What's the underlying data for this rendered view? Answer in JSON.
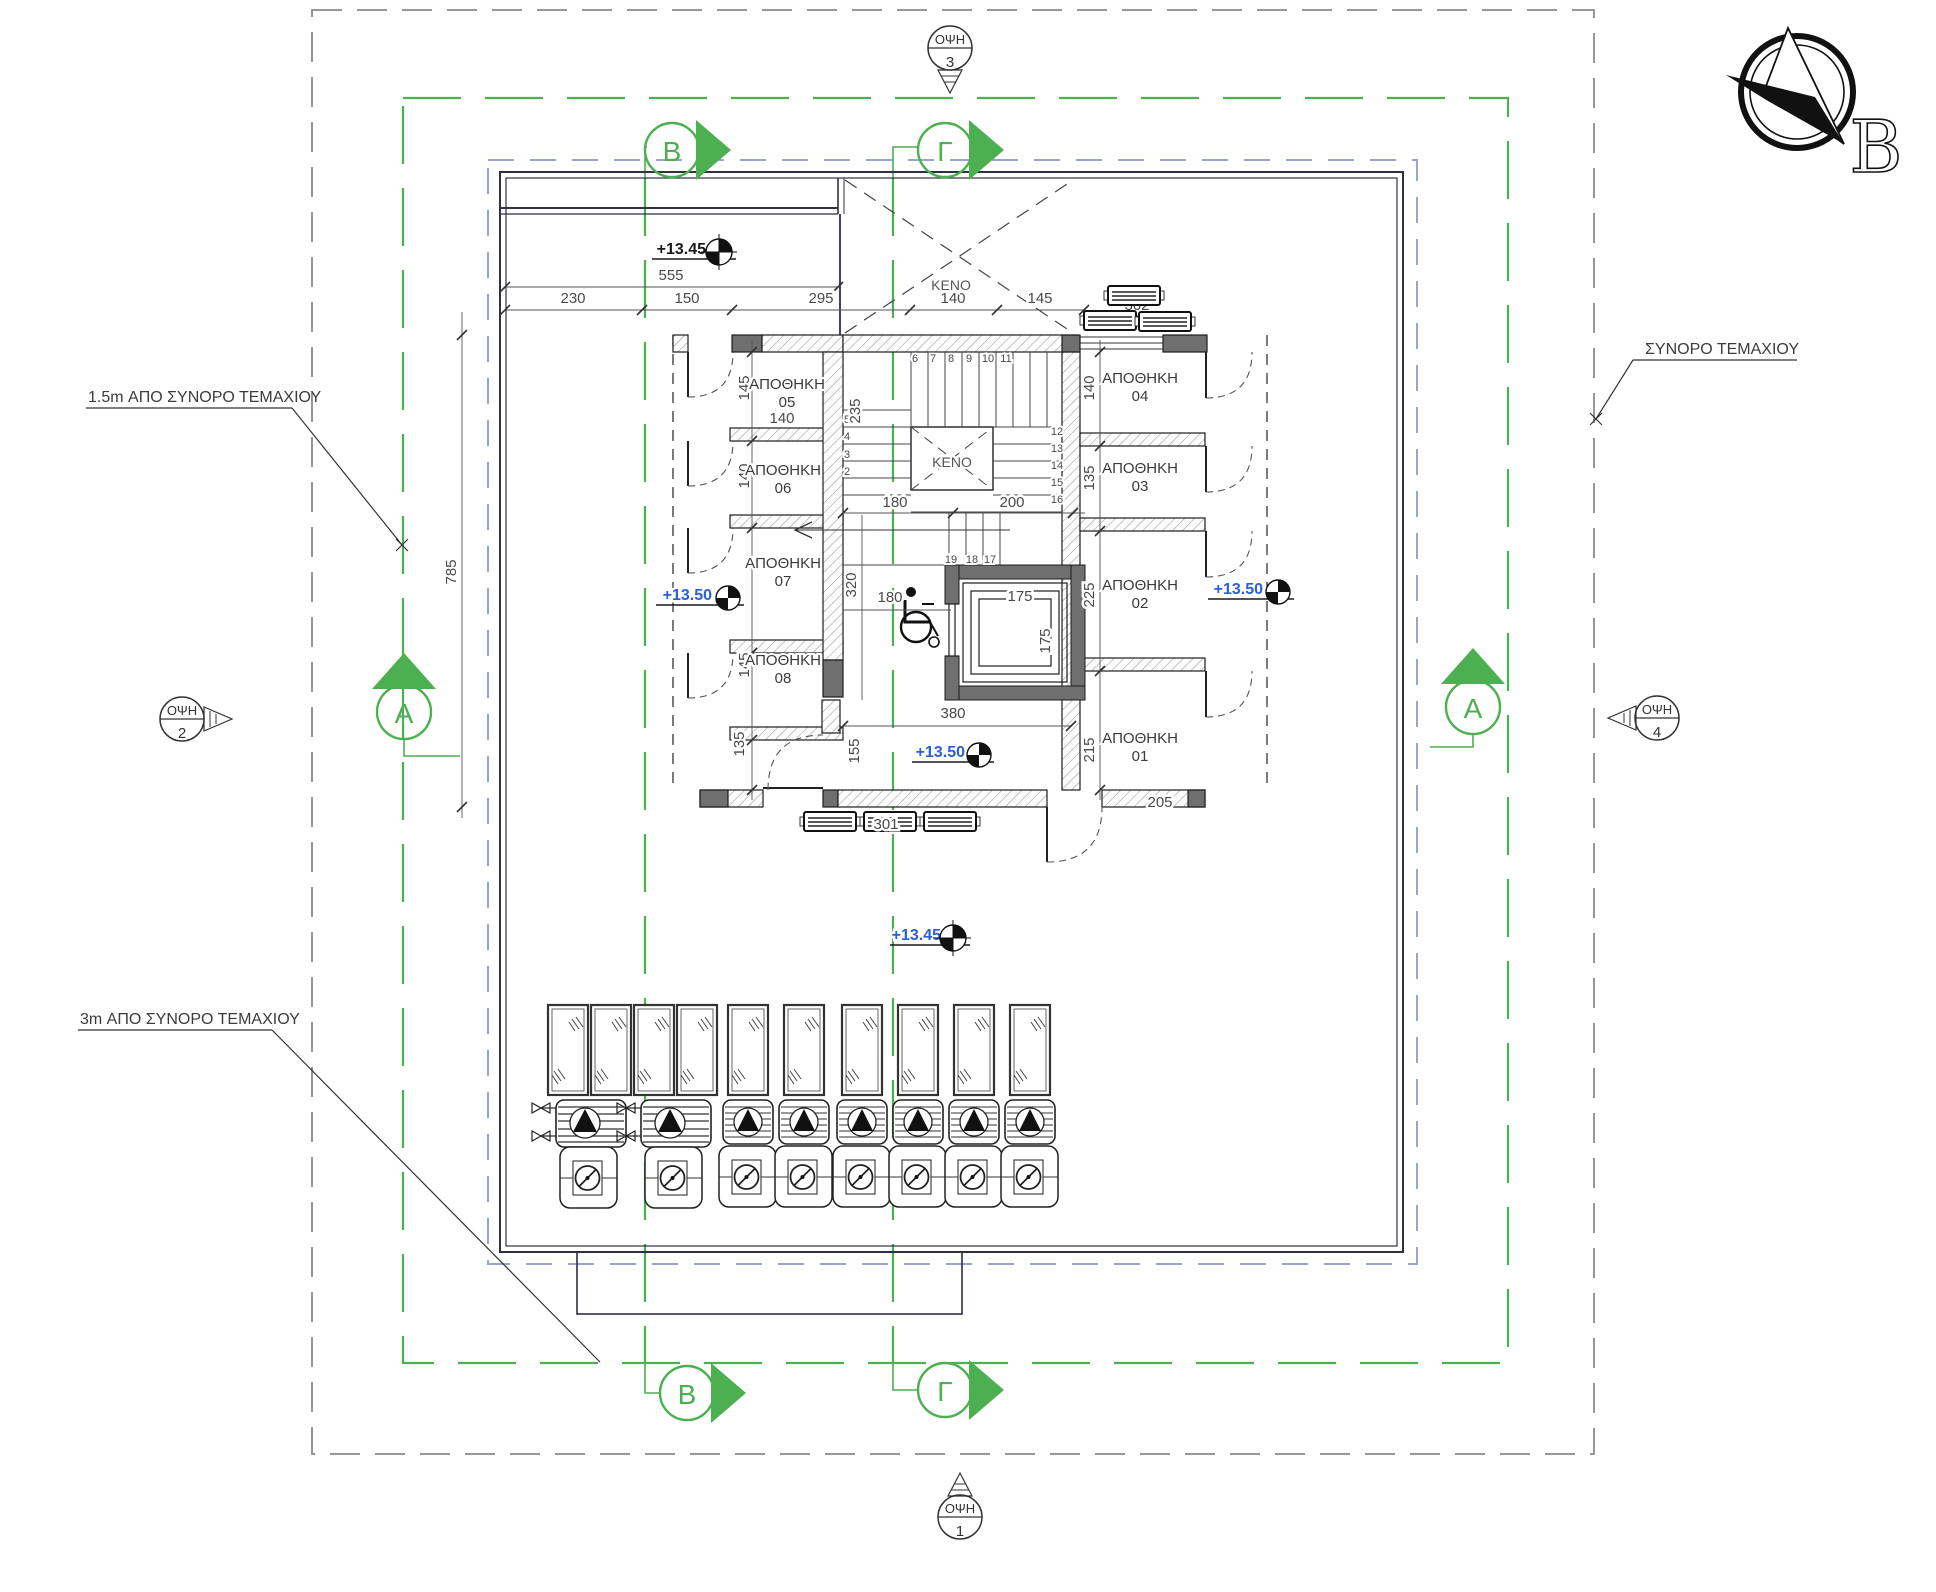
{
  "north": {
    "letter": "B"
  },
  "boundaries": {
    "setback_left": "1.5m  ΑΠΟ  ΣΥΝΟΡΟ  ΤΕΜΑΧΙΟΥ",
    "setback_bottom": "3m  ΑΠΟ  ΣΥΝΟΡΟ  ΤΕΜΑΧΙΟΥ",
    "plot_right": "ΣΥΝΟΡΟ  ΤΕΜΑΧΙΟΥ"
  },
  "views": {
    "v1": {
      "label": "ΟΨΗ",
      "num": "1"
    },
    "v2": {
      "label": "ΟΨΗ",
      "num": "2"
    },
    "v3": {
      "label": "ΟΨΗ",
      "num": "3"
    },
    "v4": {
      "label": "ΟΨΗ",
      "num": "4"
    }
  },
  "sections": {
    "b_top": "Β",
    "g_top": "Γ",
    "b_bottom": "Β",
    "g_bottom": "Γ",
    "a_left": "Α",
    "a_right": "Α"
  },
  "levels": {
    "roof_top": "+13.45",
    "terrace": "+13.45",
    "storage_left": "+13.50",
    "storage_right": "+13.50",
    "core": "+13.50"
  },
  "voids": {
    "roof": "ΚΕΝΟ",
    "stair": "ΚΕΝΟ"
  },
  "rooms": [
    {
      "label": "ΑΠΟΘΗΚΗ",
      "num": "05"
    },
    {
      "label": "ΑΠΟΘΗΚΗ",
      "num": "06"
    },
    {
      "label": "ΑΠΟΘΗΚΗ",
      "num": "07"
    },
    {
      "label": "ΑΠΟΘΗΚΗ",
      "num": "08"
    },
    {
      "label": "ΑΠΟΘΗΚΗ",
      "num": "04"
    },
    {
      "label": "ΑΠΟΘΗΚΗ",
      "num": "03"
    },
    {
      "label": "ΑΠΟΘΗΚΗ",
      "num": "02"
    },
    {
      "label": "ΑΠΟΘΗΚΗ",
      "num": "01"
    }
  ],
  "dims": {
    "total_top": "555",
    "top_row": [
      "230",
      "150",
      "295",
      "140",
      "145"
    ],
    "total_left": "785",
    "r05_w": "140",
    "r05_h": "145",
    "r06_h": "140",
    "r08_h": "145",
    "stair_width": "235",
    "run_left": "180",
    "run_right": "200",
    "lobby_h": "320",
    "lobby_w": "180",
    "cab_w": "175",
    "cab_h": "175",
    "south_h": "135",
    "south_w": "155",
    "core_w": "380",
    "r04_h": "140",
    "r03_h": "135",
    "r02_h": "225",
    "r01_h": "215",
    "r01_w": "205"
  },
  "equipment": {
    "ac_top": "302",
    "ac_bottom": "301"
  },
  "stairs": {
    "top": [
      "6",
      "7",
      "8",
      "9",
      "10",
      "11"
    ],
    "right": [
      "12",
      "13",
      "14",
      "15",
      "16"
    ],
    "bottom": [
      "19",
      "18",
      "17"
    ],
    "left": [
      "5",
      "4",
      "3",
      "2"
    ]
  },
  "colors": {
    "green": "#4caf50",
    "blue_dash": "#9aa3d6",
    "elevation": "#2b5fd9",
    "wall_dark": "#6f6f6f"
  }
}
